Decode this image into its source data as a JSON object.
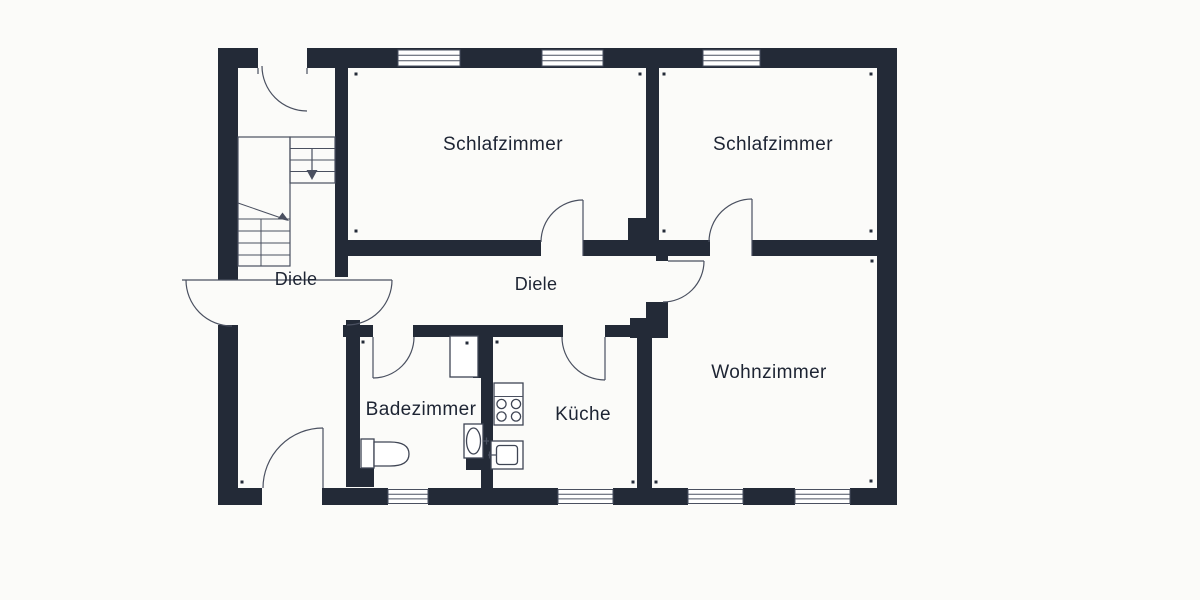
{
  "floorplan": {
    "rooms": {
      "bedroom1": {
        "label": "Schlafzimmer"
      },
      "bedroom2": {
        "label": "Schlafzimmer"
      },
      "living_room": {
        "label": "Wohnzimmer"
      },
      "hall_upper": {
        "label": "Diele"
      },
      "hall_center": {
        "label": "Diele"
      },
      "bathroom": {
        "label": "Badezimmer"
      },
      "kitchen": {
        "label": "Küche"
      }
    },
    "icons": [
      "staircase-icon",
      "stairs-down-arrow-icon",
      "door-swing-icon",
      "window-icon",
      "toilet-icon",
      "washbasin-icon",
      "stove-icon",
      "kitchen-sink-icon",
      "shower-niche-icon"
    ],
    "colors": {
      "wall": "#232a37",
      "line": "#4a5060",
      "text": "#1d2433",
      "background": "#fbfbf9",
      "window_fill": "#ffffff"
    },
    "counts": {
      "windows": 7,
      "door_swings": 8
    }
  }
}
